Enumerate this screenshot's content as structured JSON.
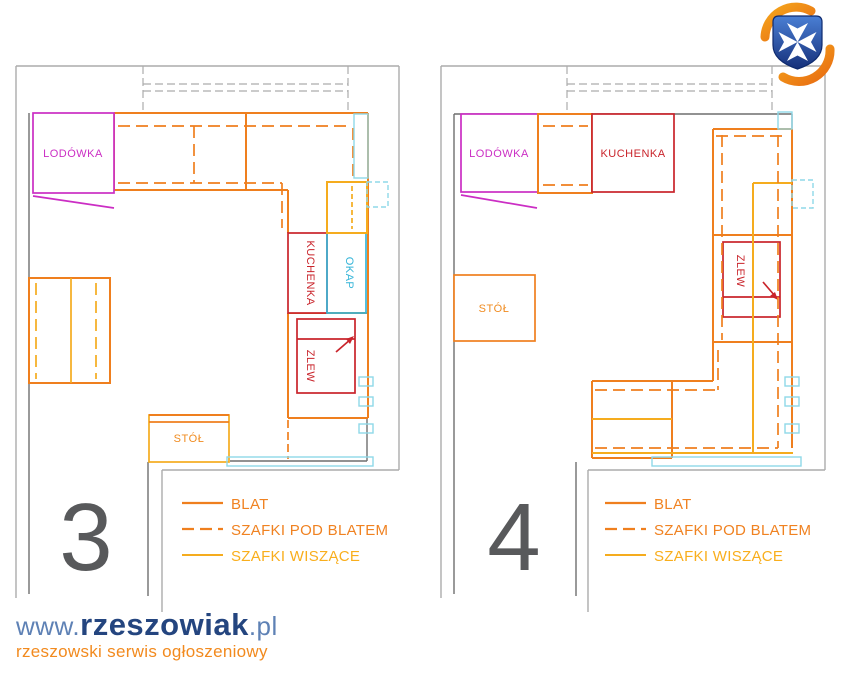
{
  "plan3": {
    "number": "3",
    "fridge_label": "LODÓWKA",
    "stove_label": "KUCHENKA",
    "hood_label": "OKAP",
    "sink_label": "ZLEW",
    "table_label": "STÓŁ"
  },
  "plan4": {
    "number": "4",
    "fridge_label": "LODÓWKA",
    "stove_label": "KUCHENKA",
    "sink_label": "ZLEW",
    "table_label": "STÓŁ"
  },
  "legend": {
    "blat": "BLAT",
    "szafki_pod_blatem": "SZAFKI POD BLATEM",
    "szafki_wiszace": "SZAFKI WISZĄCE"
  },
  "branding": {
    "www": "www.",
    "name": "rzeszowiak",
    "tld": ".pl",
    "tagline": "rzeszowski serwis ogłoszeniowy"
  },
  "colors": {
    "counter_orange": "#EF7F1E",
    "hanging_gold": "#F5AC1E",
    "appliance_red": "#C9242B",
    "hood_cyan": "#35B5D8",
    "fixture_light_cyan": "#8FD9E8",
    "fridge_magenta": "#CB2EC4",
    "wall_gray": "#ACACAC",
    "wall_dark_gray": "#6F6F6F",
    "number_gray": "#58595B",
    "brand_blue": "#5E81B5",
    "brand_navy": "#24457F",
    "brand_orange": "#F28A1E"
  }
}
